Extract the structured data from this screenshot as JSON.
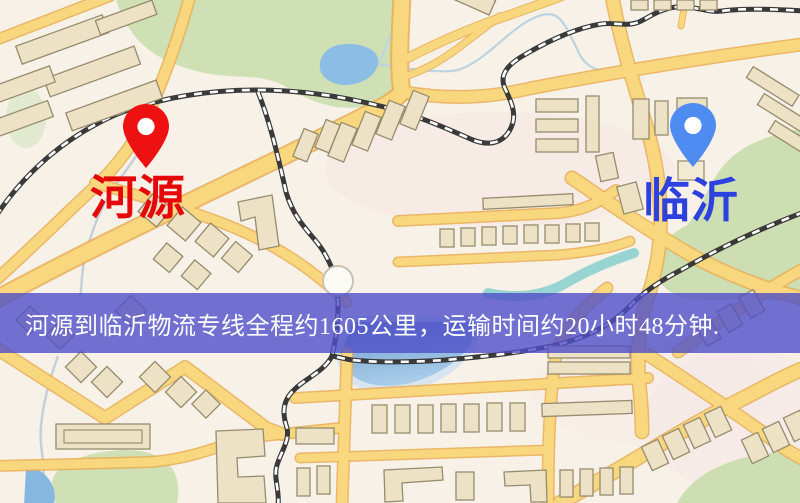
{
  "map": {
    "origin": {
      "label": "河源",
      "pin_color": "#ee1111",
      "label_color": "#e60808"
    },
    "destination": {
      "label": "临沂",
      "pin_color": "#4f8cf2",
      "label_color": "#2c41dd"
    }
  },
  "banner": {
    "text": "河源到临沂物流专线全程约1605公里，运输时间约20小时48分钟.",
    "background_color": "#4f4fc8",
    "text_color": "#ffffff"
  },
  "legend_colors": {
    "road": "#f8d77e",
    "road_casing": "#e9ad52",
    "greenspace": "#cfe0b4",
    "water": "#8cbde4",
    "building": "#eee2c6",
    "railway": "#3a3a3a"
  }
}
